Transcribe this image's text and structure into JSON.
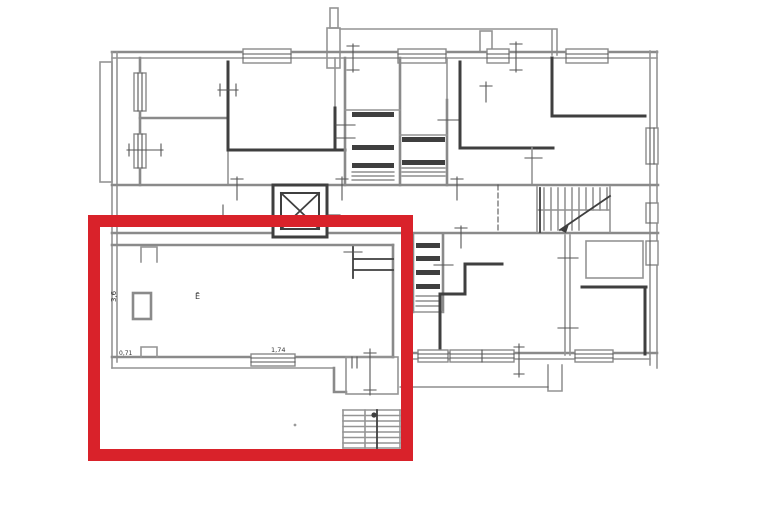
{
  "plan": {
    "background_color": "#ffffff",
    "wall_color": "#8a8a8a",
    "dark_wall_color": "#3f3f3f",
    "highlight": {
      "color": "#d9222a",
      "thickness_px": 12
    },
    "labels": {
      "left_dim": "3,6",
      "room_label": "Ē",
      "bottom_left_dim": "0,71",
      "bottom_dim": "1,74"
    },
    "icons": {
      "elevator_shaft": "x-cross",
      "main_staircase": "tread-hatch",
      "exterior_staircase": "tread-hatch"
    }
  }
}
